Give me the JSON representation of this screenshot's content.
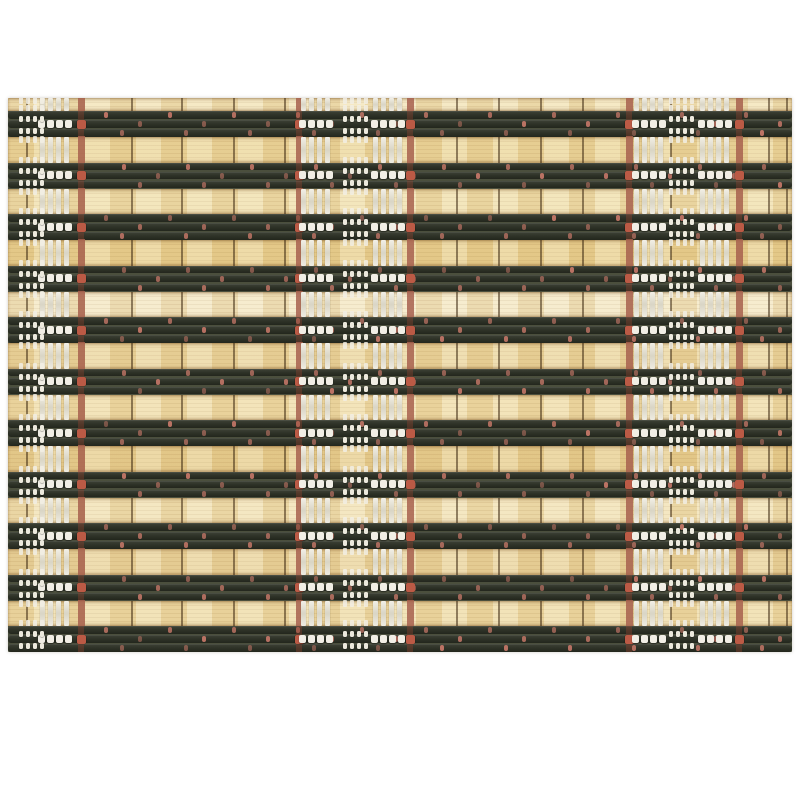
{
  "photo": {
    "subject": "woven bamboo placemat",
    "background_color": "#ffffff"
  },
  "mat": {
    "left": 8,
    "top": 98,
    "width": 784,
    "height": 554,
    "top_sliver_h": 13,
    "dark_band_count": 11,
    "dark_band_h": 26,
    "dark_slats_per_band": 3,
    "colors": {
      "bamboo_base": "#eedcab",
      "dark_slat": "#2d3126",
      "band_gap": "#4b4f3d",
      "warp_line": "#3e2a12",
      "red_thread": "#a7604e",
      "red_thread_on_slat": "#bb5a45",
      "red_dot": "#c57768",
      "stitch_white": "#f1eee5"
    },
    "bamboo_palette": [
      "#f2e4ba",
      "#ecd8a0",
      "#f0e0b0",
      "#e9d295",
      "#f3e8c6",
      "#ebd7a2",
      "#efdeac",
      "#e8d094",
      "#f1e2b6",
      "#ead5a0",
      "#eedcaa"
    ],
    "separators_x": [
      18,
      123,
      173,
      225,
      276,
      448,
      490,
      532,
      574,
      662,
      760,
      778
    ],
    "red_threads_x": [
      70,
      288,
      399,
      618,
      728
    ],
    "clusters_x": [
      32,
      293,
      365,
      626,
      692
    ],
    "cluster": {
      "bar_count": 4,
      "bar_pitch": 8,
      "square_pitch": 9,
      "square_count": 4
    },
    "ticks_x": [
      11,
      335,
      661
    ],
    "tick": {
      "count": 4,
      "pitch": 7
    },
    "red_dots": {
      "spacing": 64,
      "phases": [
        96,
        130,
        112
      ],
      "row_shift": 18,
      "min_x": 88
    }
  }
}
